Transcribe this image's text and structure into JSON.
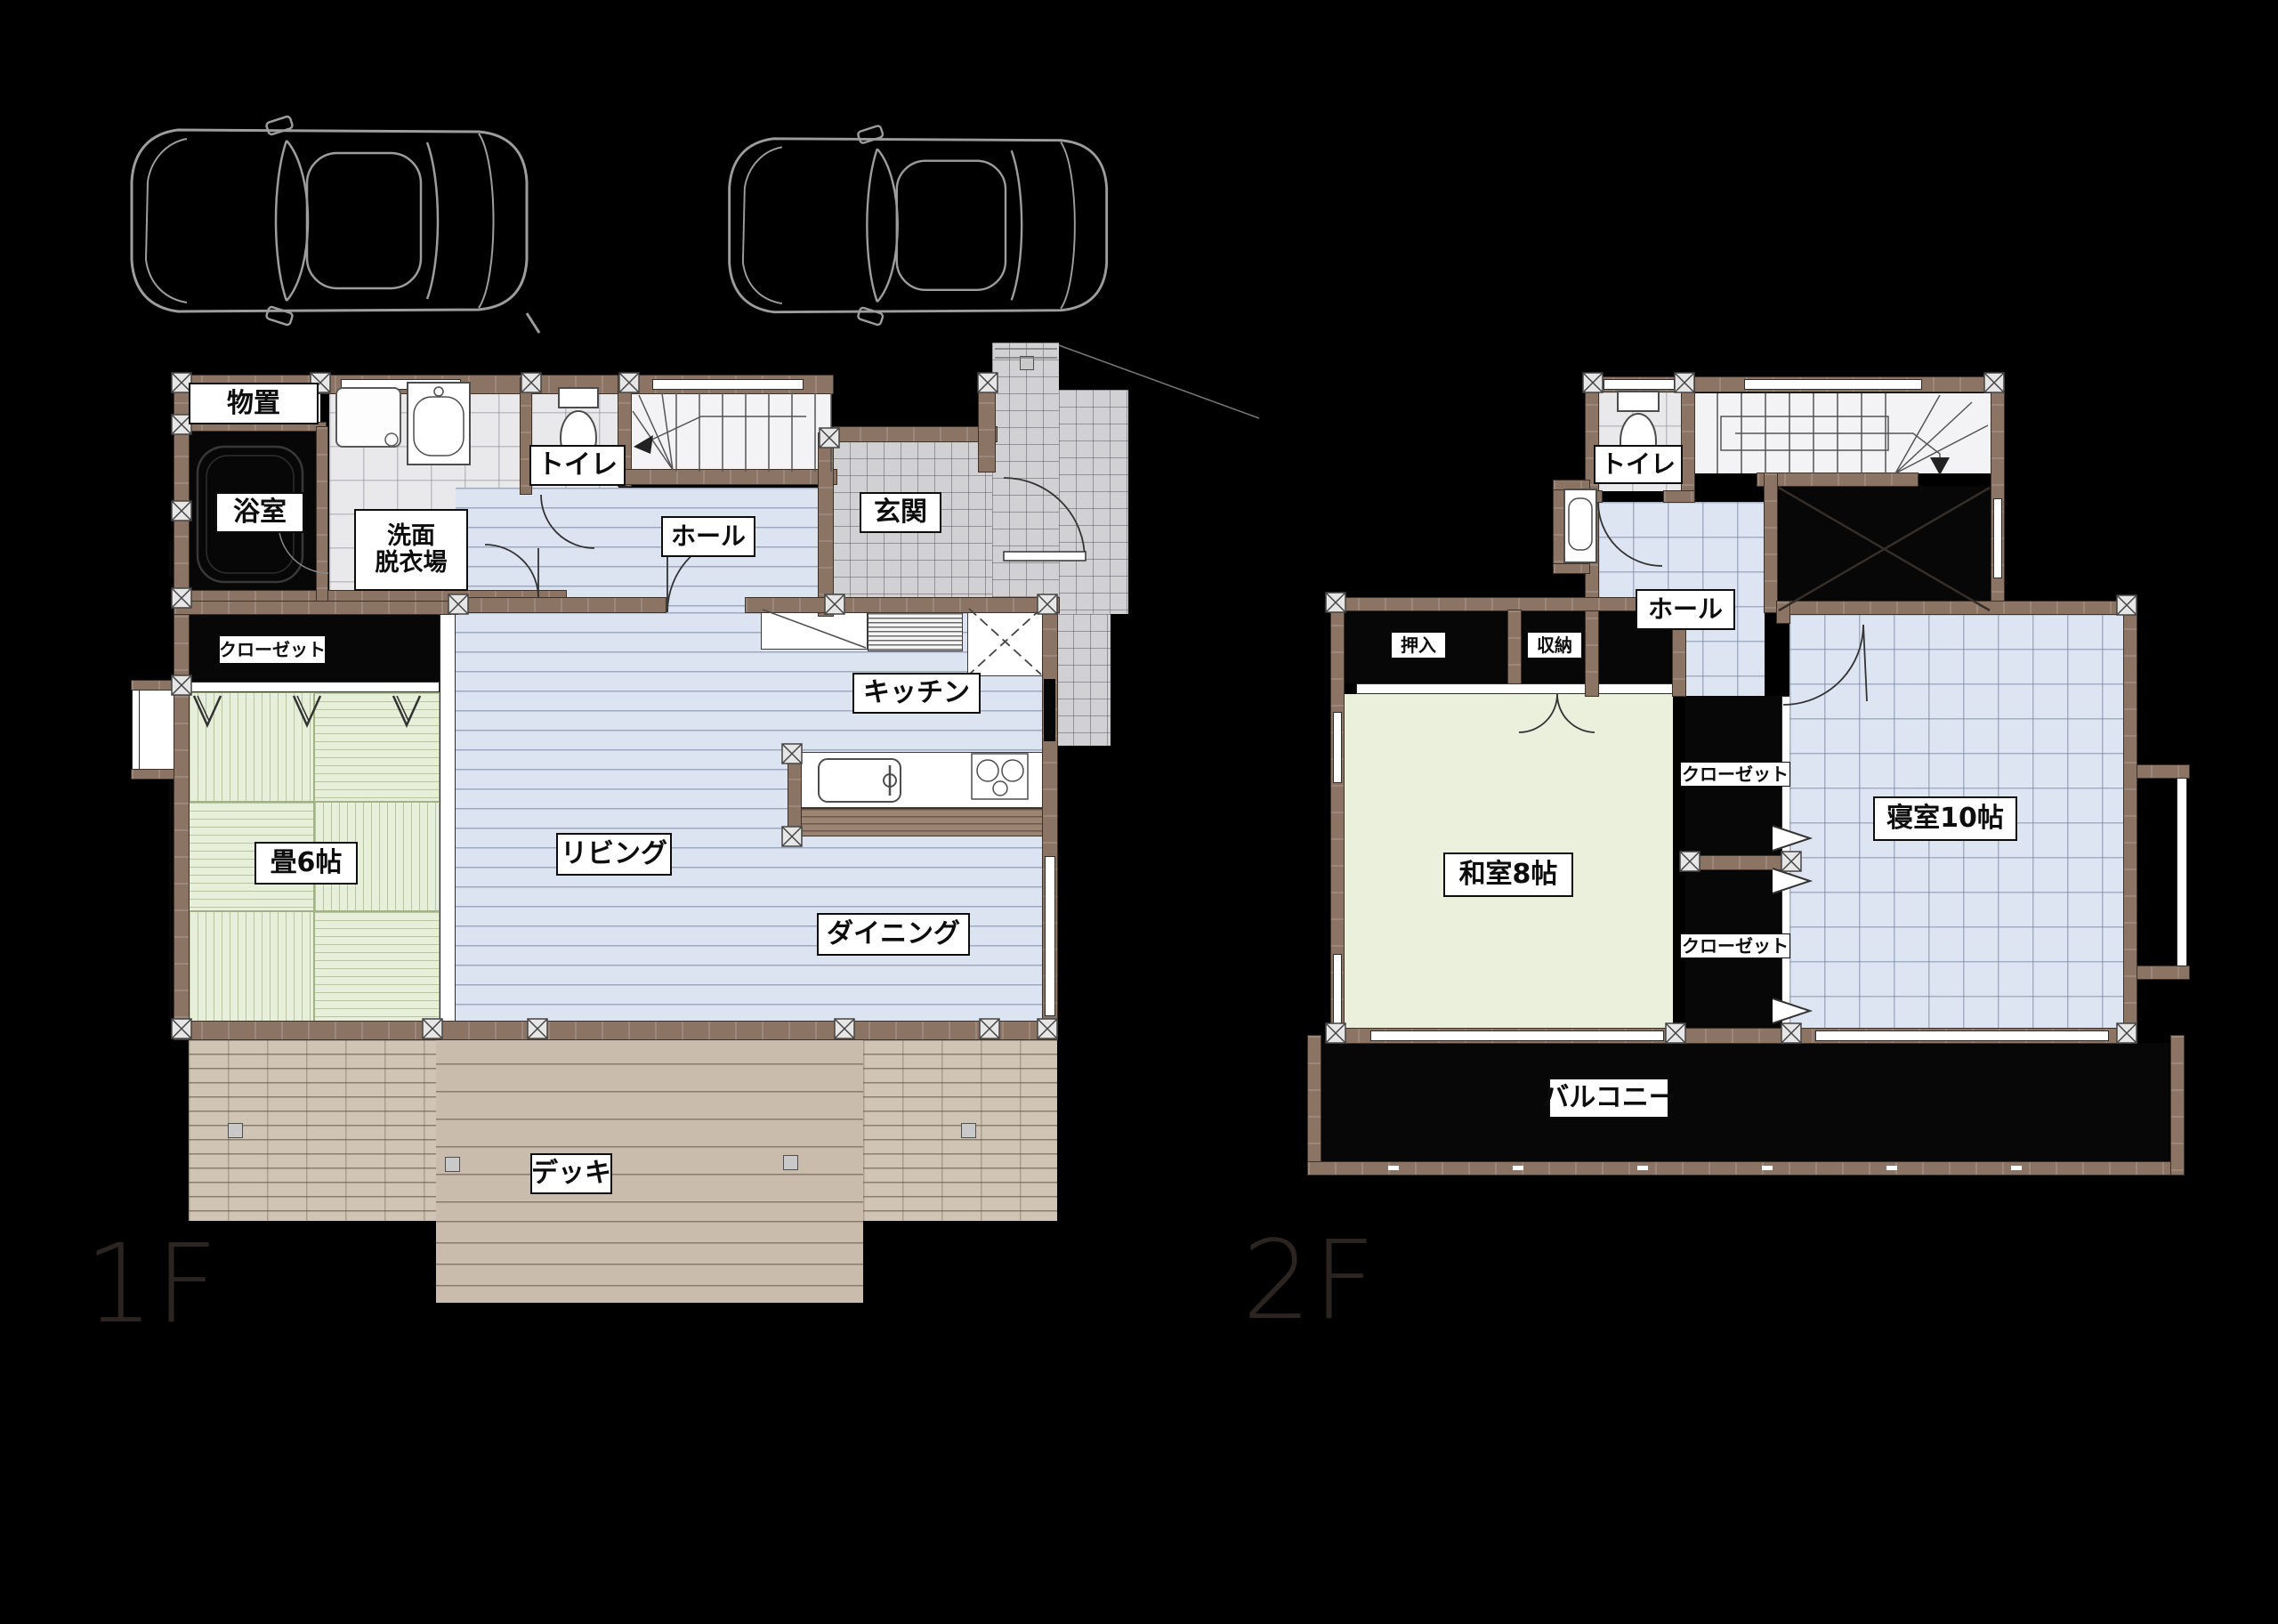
{
  "page": {
    "background": "#000000",
    "type": "architectural-floor-plan"
  },
  "colors": {
    "wall": "#8c7465",
    "label_bg": "#ffffff",
    "label_text": "#0d0d0d",
    "wood_floor": "#dce4f1",
    "tatami_1f": "#e7eed9",
    "tatami_2f": "#eaf0dc",
    "tile_entrance": "#d1d1d4",
    "tile_wash": "#e9e9ec",
    "deck": "#c9bcad",
    "brick": "#d0c4b4",
    "dark_room": "#070707",
    "car_outline": "#9d9d9d",
    "floor_title": "#2b2421"
  },
  "floors": [
    {
      "id": "1F",
      "title": "1F",
      "rooms": [
        {
          "name": "storage",
          "label": "物置"
        },
        {
          "name": "bathroom",
          "label": "浴室"
        },
        {
          "name": "washroom",
          "label": "洗面",
          "label2": "脱衣場"
        },
        {
          "name": "toilet",
          "label": "トイレ"
        },
        {
          "name": "hall",
          "label": "ホール"
        },
        {
          "name": "entrance",
          "label": "玄関"
        },
        {
          "name": "kitchen",
          "label": "キッチン"
        },
        {
          "name": "closet",
          "label": "クローゼット"
        },
        {
          "name": "tatami-room",
          "label": "畳6帖"
        },
        {
          "name": "living",
          "label": "リビング"
        },
        {
          "name": "dining",
          "label": "ダイニング"
        },
        {
          "name": "deck",
          "label": "デッキ"
        }
      ]
    },
    {
      "id": "2F",
      "title": "2F",
      "rooms": [
        {
          "name": "toilet",
          "label": "トイレ"
        },
        {
          "name": "hall",
          "label": "ホール"
        },
        {
          "name": "futon-closet",
          "label": "押入"
        },
        {
          "name": "storage",
          "label": "収納"
        },
        {
          "name": "closet-upper",
          "label": "クローゼット"
        },
        {
          "name": "closet-lower",
          "label": "クローゼット"
        },
        {
          "name": "japanese-room",
          "label": "和室8帖"
        },
        {
          "name": "bedroom",
          "label": "寝室10帖"
        },
        {
          "name": "balcony",
          "label": "バルコニー"
        }
      ]
    }
  ]
}
